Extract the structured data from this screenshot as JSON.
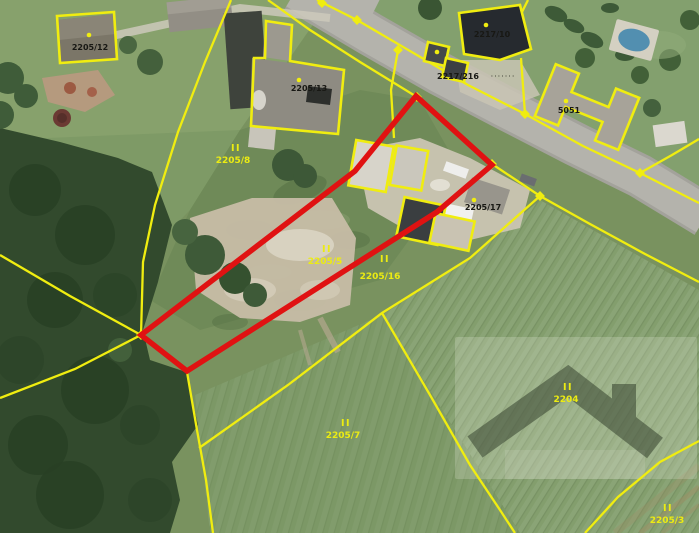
{
  "map": {
    "kind": "cadastral-orthophoto-view",
    "grass_symbol": "II",
    "leader_dots": "·······",
    "colors": {
      "parcel_line": "#f0ed10",
      "highlight_outline": "#e01212",
      "parcel_label": "#ecec12",
      "building_label": "#181814",
      "road": "#b4b3ac"
    },
    "parcel_labels": [
      {
        "label": "2205/8"
      },
      {
        "label": "2205/5"
      },
      {
        "label": "2205/16"
      },
      {
        "label": "2205/7"
      },
      {
        "label": "2204"
      },
      {
        "label": "2205/3"
      }
    ],
    "building_labels": [
      {
        "label": "2205/12"
      },
      {
        "label": "2205/13"
      },
      {
        "label": "2217/10"
      },
      {
        "label": "2217/216"
      },
      {
        "label": "5051"
      },
      {
        "label": "2205/17"
      }
    ]
  }
}
